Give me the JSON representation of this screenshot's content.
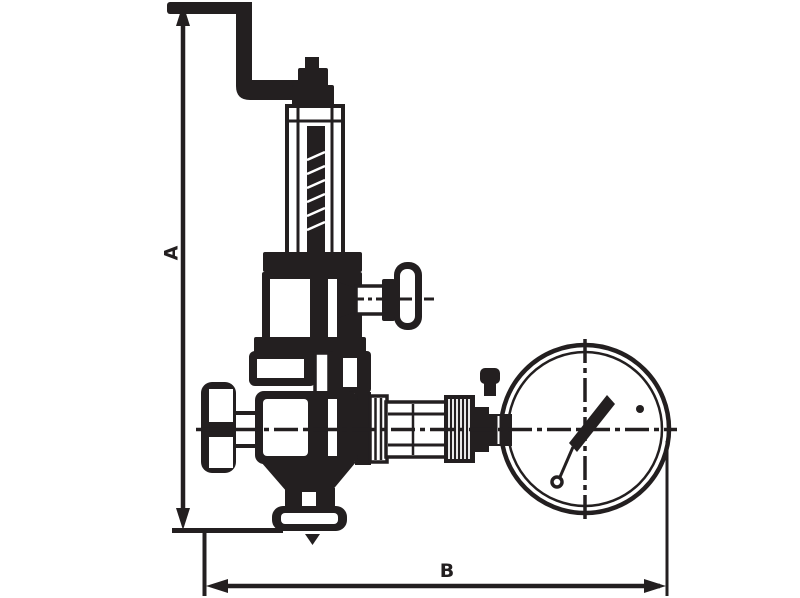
{
  "page": {
    "background_color": "#ffffff",
    "line_color": "#231f20"
  },
  "diagram": {
    "type": "technical line drawing",
    "subject": "pressure reducing valve with crank handle, side tee handle and pressure gauge",
    "dimension_labels": {
      "vertical": "A",
      "horizontal": "B"
    },
    "parts": [
      "crank handle",
      "adjusting stem nut",
      "spring bonnet tube",
      "threaded stem",
      "bonnet flange",
      "spring housing",
      "side tee handle",
      "body top flange",
      "valve body",
      "inlet union flange",
      "outlet neck",
      "bottom outlet flange",
      "flow direction arrow",
      "gauge connection union",
      "knurled coupling nut",
      "pressure gauge",
      "gauge needle"
    ]
  }
}
